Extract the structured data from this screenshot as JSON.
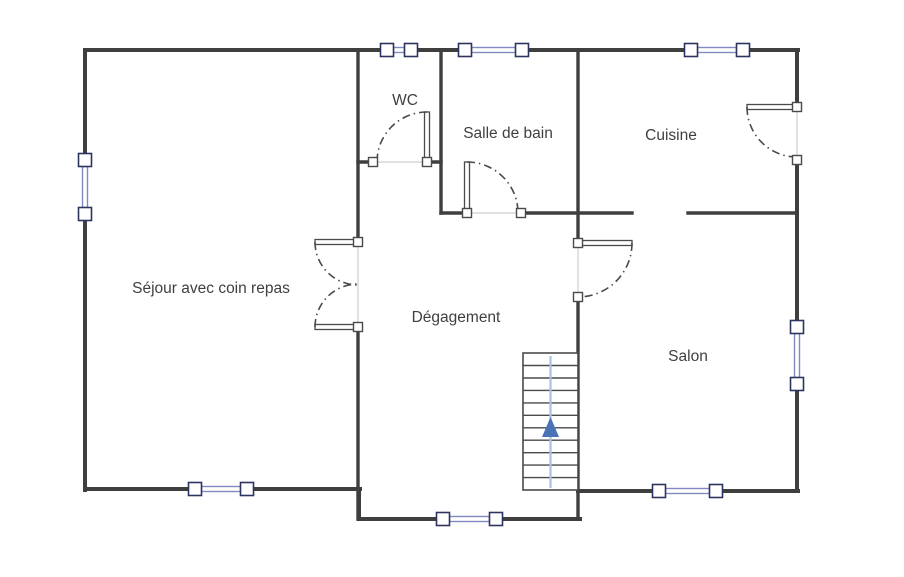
{
  "plan": {
    "type": "floor-plan",
    "rooms": [
      {
        "name": "Séjour avec coin repas"
      },
      {
        "name": "WC"
      },
      {
        "name": "Salle de bain"
      },
      {
        "name": "Cuisine"
      },
      {
        "name": "Dégagement"
      },
      {
        "name": "Salon"
      }
    ],
    "stairs": {
      "direction": "up",
      "steps": 11
    },
    "counts": {
      "windows": 8,
      "doors": 6
    },
    "colors": {
      "wall": "#3f3f3f",
      "thin_line": "#cfcfcf",
      "window_frame": "#2e3460",
      "window_glass": "#8089c0",
      "door_line": "#4a4a4a",
      "stair_rail": "#a9c3de",
      "stair_arrow": "#4a73b5",
      "label_text": "#3f3f3f"
    }
  }
}
